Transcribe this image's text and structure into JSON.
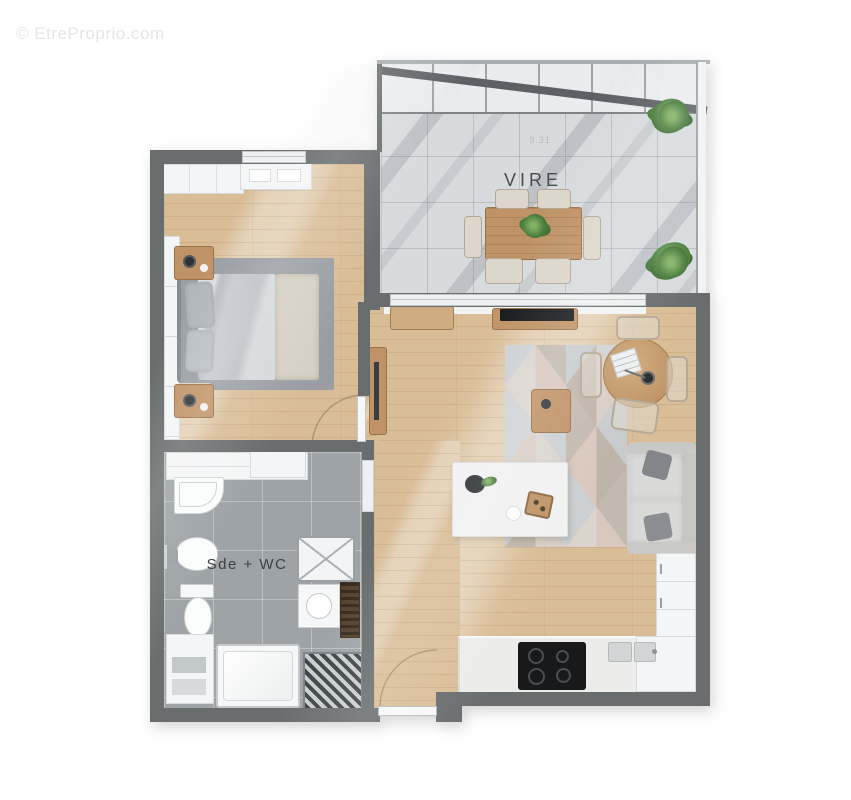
{
  "watermark": "© EtreProprio.com",
  "labels": {
    "terrace_room": "VIRE",
    "terrace_dimension": "9.31",
    "bathroom_room": "Sde + WC"
  },
  "rooms": [
    {
      "id": "terrace",
      "label": "VIRE",
      "features": [
        "glass-roof",
        "wood-dining-table",
        "six-chairs",
        "two-potted-plants",
        "tiled-floor"
      ]
    },
    {
      "id": "bedroom",
      "label": "",
      "features": [
        "double-bed",
        "two-nightstands",
        "wardrobe",
        "closet",
        "gray-rug",
        "wood-floor"
      ]
    },
    {
      "id": "living-kitchen",
      "label": "",
      "features": [
        "sofa",
        "geometric-rug",
        "coffee-table",
        "round-table",
        "tv-sideboard",
        "white-island-table",
        "kitchen-counter",
        "cooktop",
        "sink",
        "wood-floor"
      ]
    },
    {
      "id": "bathroom",
      "label": "Sde + WC",
      "features": [
        "shower-tray",
        "toilet",
        "two-basins",
        "washer-unit",
        "shelf-unit",
        "tiled-floor"
      ]
    },
    {
      "id": "hall",
      "label": "",
      "features": [
        "entrance-door",
        "wood-console"
      ]
    }
  ],
  "palette": {
    "wall": "#696d6e",
    "wood_floor": "#d9bd97",
    "terrace_tile": "#d8dbdd",
    "bath_tile": "#9da3a7",
    "white_furniture": "#f4f5f6",
    "wood_furniture": "#c09367",
    "sofa": "#d2d2d0",
    "bed_duvet": "#c7cbd0",
    "plant": "#4e8040",
    "cooktop": "#17191b",
    "watermark_color": "#e2e6e9",
    "label_color": "#494c4f",
    "rug_colors": [
      "#ccd2d7",
      "#dad0c9",
      "#c2bab1",
      "#dcd7d2",
      "#c7cdd2",
      "#d9c9c0",
      "#cfd5da",
      "#beb4ab"
    ]
  }
}
